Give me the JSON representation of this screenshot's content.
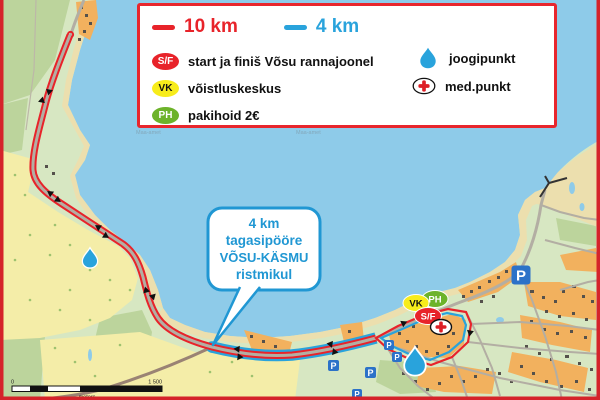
{
  "colors": {
    "sea": "#8ecbe9",
    "land": "#d7e7c2",
    "forest_dark": "#bcd49c",
    "field": "#f4eda8",
    "beach": "#ecdfae",
    "village_orange": "#f2b15e",
    "building": "#55514b",
    "road_gray": "#b3aea3",
    "road_brown": "#9a8374",
    "route_red": "#e8232a",
    "route_blue": "#29a3dc",
    "frame_red": "#d5232a",
    "legend_border": "#e8262d",
    "callout_blue": "#2097d3",
    "vk_yellow": "#f7ec1b",
    "ph_green": "#6db32a",
    "sf_red": "#e8232a",
    "med_red": "#dd1f26",
    "drop_blue": "#29a3dc",
    "p_blue": "#2c72c8",
    "tree_dot": "#9dc26f",
    "pond": "#8ecbe9"
  },
  "legend": {
    "route10_label": "10 km",
    "route4_label": "4 km",
    "items": [
      {
        "badge": "S/F",
        "label": "start ja finiš Võsu rannajoonel"
      },
      {
        "badge": "VK",
        "label": "võistluskeskus"
      },
      {
        "badge": "PH",
        "label": "pakihoid 2€"
      }
    ],
    "right_items": [
      {
        "icon": "water-drop-icon",
        "label": "joogipunkt"
      },
      {
        "icon": "med-cross-icon",
        "label": "med.punkt"
      }
    ]
  },
  "callout": {
    "lines": [
      "4 km",
      "tagasipööre",
      "VÕSU-KÄSMU",
      "ristmikul"
    ]
  },
  "map_markers": {
    "sf": "S/F",
    "vk": "VK",
    "ph": "PH",
    "parking": "P"
  },
  "scale_bar": {
    "left_label": "0",
    "right_label": "1 500",
    "unit_label": "meters"
  },
  "watermark": "Maa-amet"
}
